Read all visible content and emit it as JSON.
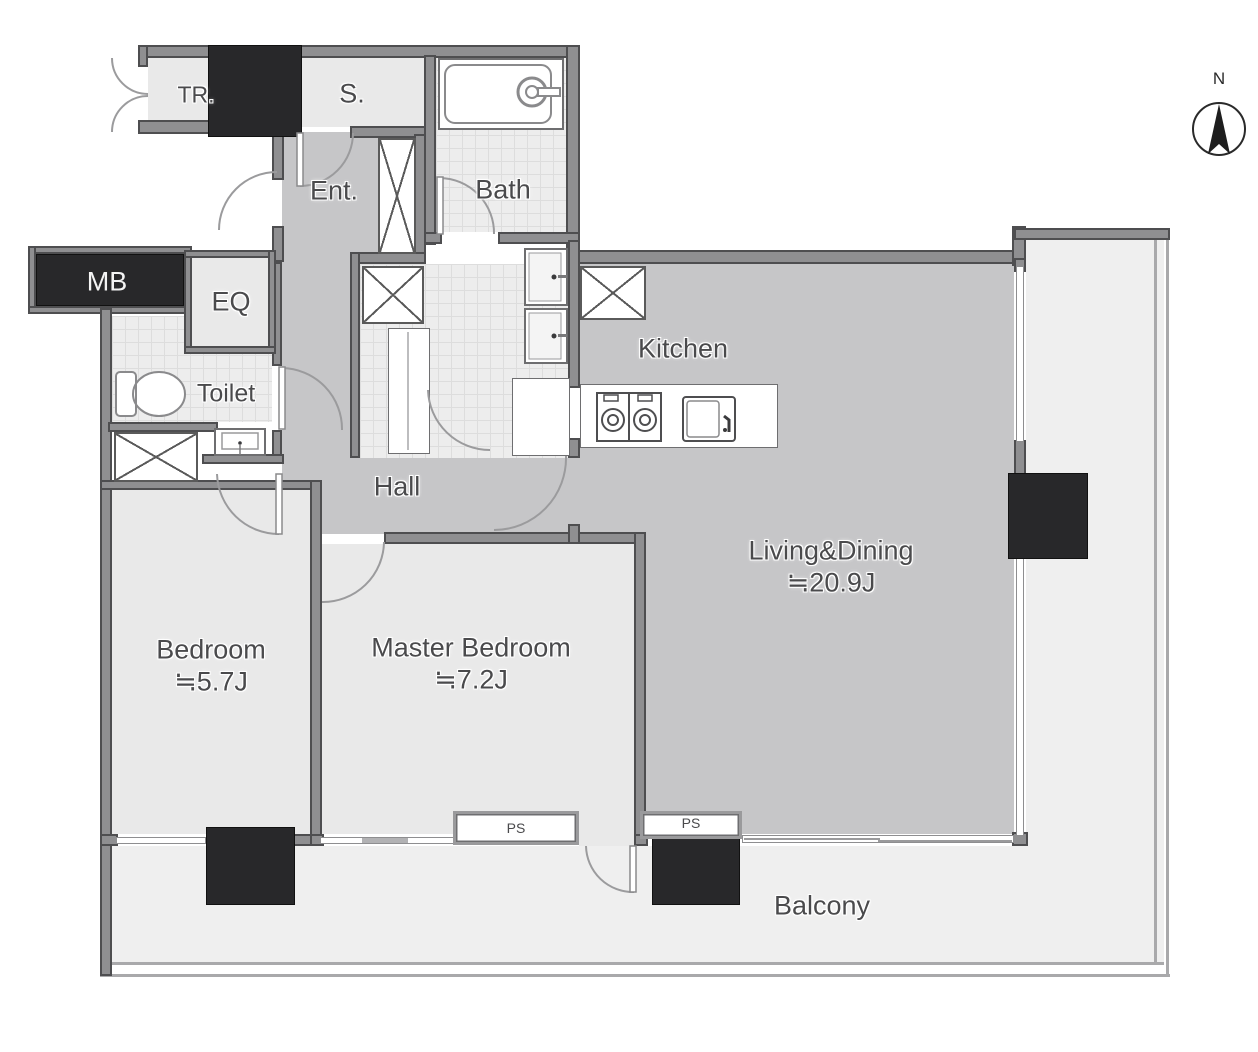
{
  "compass": {
    "north_label": "N"
  },
  "rooms": {
    "trunk": {
      "label": "TR."
    },
    "storage": {
      "label": "S."
    },
    "entrance": {
      "label": "Ent."
    },
    "bath": {
      "label": "Bath"
    },
    "meter_box": {
      "label": "MB"
    },
    "equipment": {
      "label": "EQ"
    },
    "toilet": {
      "label": "Toilet"
    },
    "hall": {
      "label": "Hall"
    },
    "kitchen": {
      "label": "Kitchen"
    },
    "living_dining": {
      "label": "Living&Dining",
      "area": "≒20.9J"
    },
    "bedroom": {
      "label": "Bedroom",
      "area": "≒5.7J"
    },
    "master_bedroom": {
      "label": "Master Bedroom",
      "area": "≒7.2J"
    },
    "balcony": {
      "label": "Balcony"
    }
  },
  "shafts": {
    "ps1": {
      "label": "PS"
    },
    "ps2": {
      "label": "PS"
    }
  },
  "colors": {
    "wall": "#8f8f91",
    "wall_edge": "#4e4e50",
    "column": "#28282a",
    "floor_main_gray": "#c6c6c8",
    "floor_room_light": "#e9e9e9",
    "floor_tile": "#ededed",
    "floor_balcony": "#efefef",
    "label_text": "#4a4a4c"
  }
}
